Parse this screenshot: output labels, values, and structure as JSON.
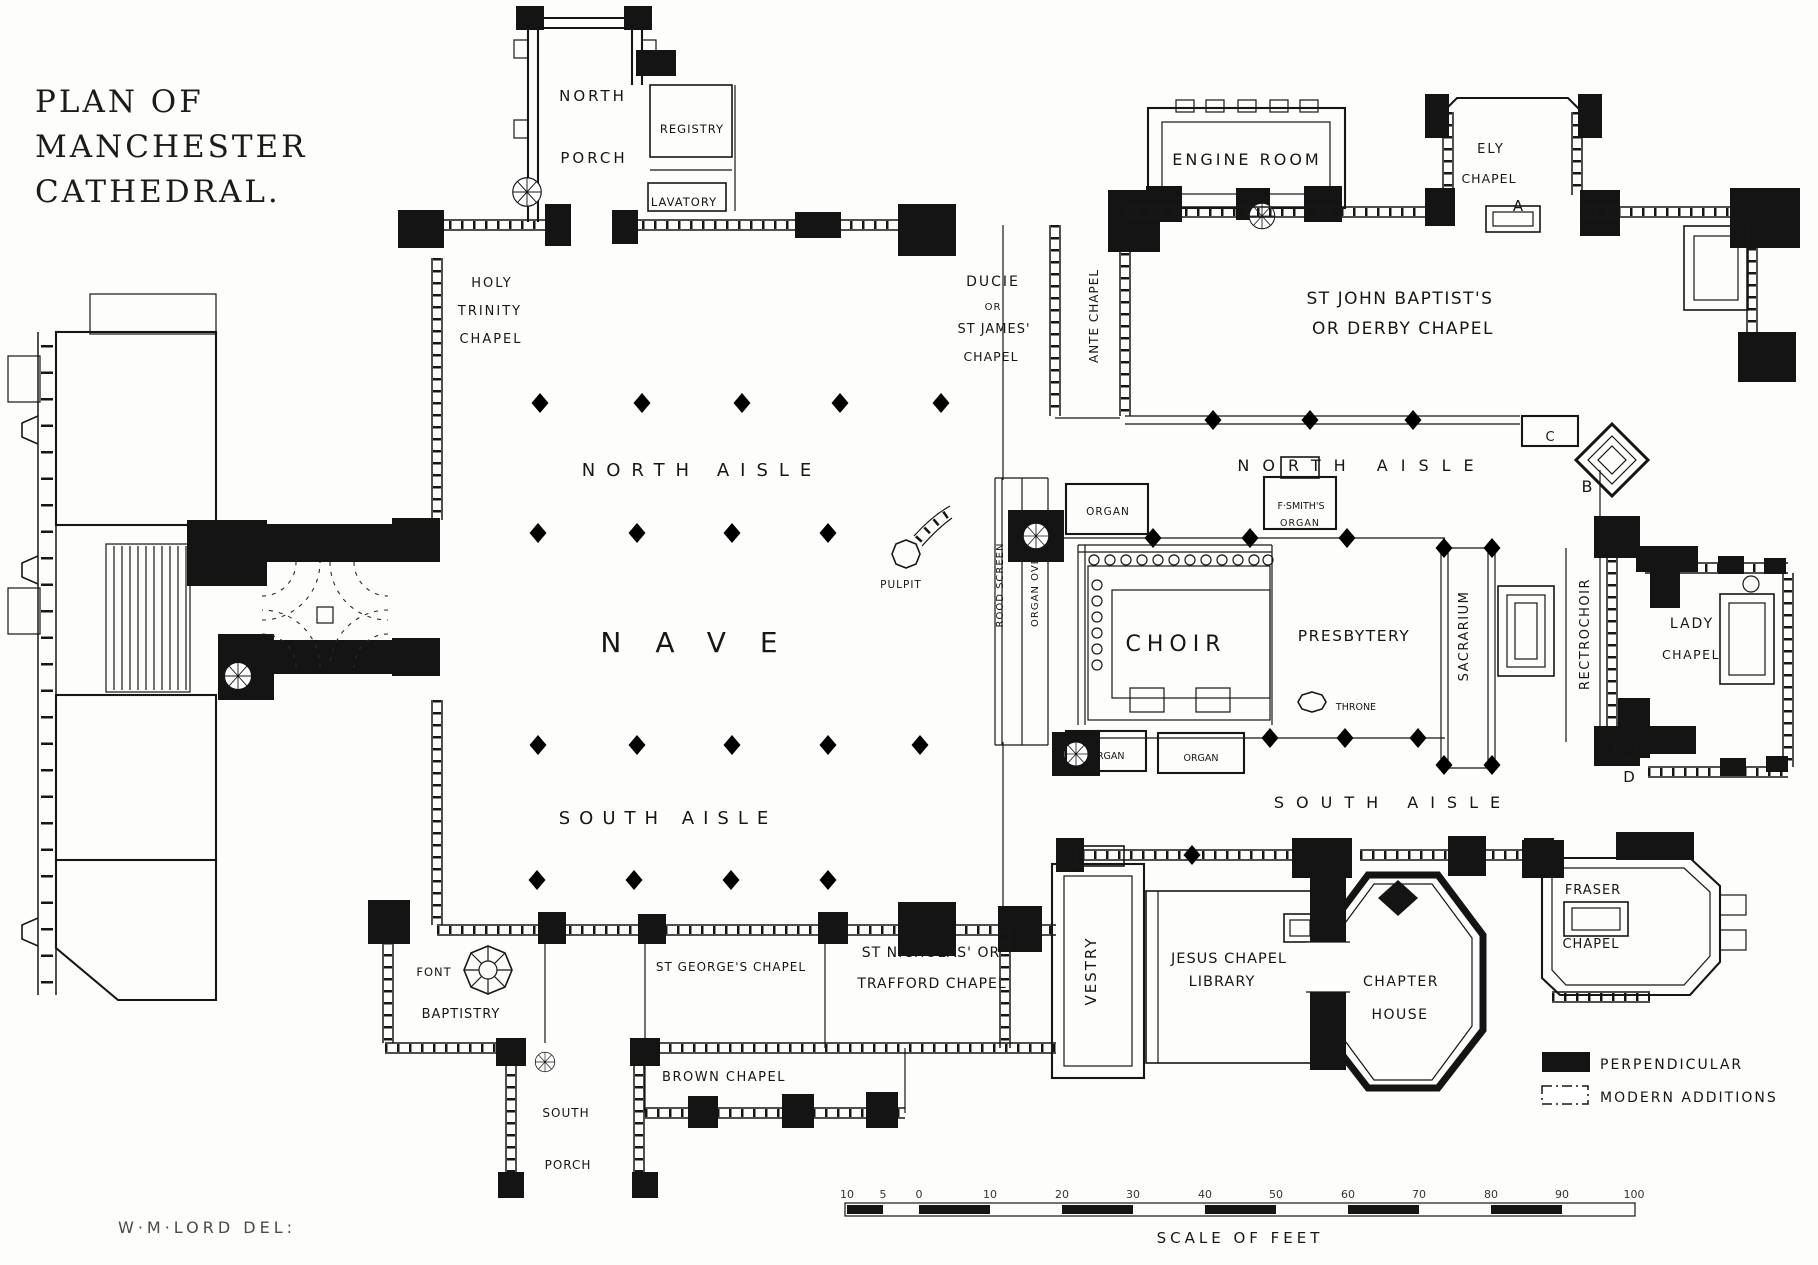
{
  "title": {
    "line1": "PLAN OF",
    "line2": "MANCHESTER",
    "line3": "CATHEDRAL."
  },
  "attribution": "W·M·LORD  DEL:",
  "legend": {
    "items": [
      {
        "label": "PERPENDICULAR",
        "style": "filled",
        "color": "#141414"
      },
      {
        "label": "MODERN ADDITIONS",
        "style": "outline",
        "color": "#ffffff"
      }
    ]
  },
  "scale": {
    "caption": "SCALE OF FEET",
    "ticks": [
      {
        "x": 847,
        "label": "10"
      },
      {
        "x": 883,
        "label": "5"
      },
      {
        "x": 919,
        "label": "0"
      },
      {
        "x": 990,
        "label": "10"
      },
      {
        "x": 1062,
        "label": "20"
      },
      {
        "x": 1133,
        "label": "30"
      },
      {
        "x": 1205,
        "label": "40"
      },
      {
        "x": 1276,
        "label": "50"
      },
      {
        "x": 1348,
        "label": "60"
      },
      {
        "x": 1419,
        "label": "70"
      },
      {
        "x": 1491,
        "label": "80"
      },
      {
        "x": 1562,
        "label": "90"
      },
      {
        "x": 1634,
        "label": "100"
      }
    ]
  },
  "plan_labels": [
    {
      "text": "NORTH",
      "x": 593,
      "y": 101,
      "size": 15,
      "ls": 3
    },
    {
      "text": "PORCH",
      "x": 594,
      "y": 163,
      "size": 15,
      "ls": 3
    },
    {
      "text": "REGISTRY",
      "x": 692,
      "y": 133,
      "size": 11.5,
      "ls": 1
    },
    {
      "text": "LAVATORY",
      "x": 684,
      "y": 206,
      "size": 11.5,
      "ls": 1
    },
    {
      "text": "HOLY",
      "x": 492,
      "y": 287,
      "size": 13,
      "ls": 2
    },
    {
      "text": "TRINITY",
      "x": 490,
      "y": 315,
      "size": 13,
      "ls": 2
    },
    {
      "text": "CHAPEL",
      "x": 491,
      "y": 343,
      "size": 13,
      "ls": 2
    },
    {
      "text": "NORTH AISLE",
      "x": 702,
      "y": 476,
      "size": 18,
      "ls": 11
    },
    {
      "text": "NAVE",
      "x": 706,
      "y": 652,
      "size": 28,
      "ls": 34
    },
    {
      "text": "SOUTH AISLE",
      "x": 668,
      "y": 824,
      "size": 18,
      "ls": 9
    },
    {
      "text": "PULPIT",
      "x": 901,
      "y": 588,
      "size": 10.5,
      "ls": 1
    },
    {
      "text": "DUCIE",
      "x": 993,
      "y": 286,
      "size": 14,
      "ls": 2
    },
    {
      "text": "OR",
      "x": 993,
      "y": 310,
      "size": 10,
      "ls": 1
    },
    {
      "text": "ST JAMES'",
      "x": 994,
      "y": 333,
      "size": 13,
      "ls": 1
    },
    {
      "text": "CHAPEL",
      "x": 991,
      "y": 361,
      "size": 12.5,
      "ls": 1
    },
    {
      "text": "ANTE CHAPEL",
      "x": 1098,
      "y": 316,
      "size": 12,
      "ls": 1,
      "rot": -90
    },
    {
      "text": "ENGINE ROOM",
      "x": 1247,
      "y": 165,
      "size": 16,
      "ls": 3
    },
    {
      "text": "ELY",
      "x": 1491,
      "y": 153,
      "size": 13,
      "ls": 2
    },
    {
      "text": "CHAPEL",
      "x": 1489,
      "y": 183,
      "size": 12.5,
      "ls": 1
    },
    {
      "text": "A",
      "x": 1518,
      "y": 211,
      "size": 15
    },
    {
      "text": "ST JOHN BAPTIST'S",
      "x": 1400,
      "y": 304,
      "size": 17,
      "ls": 1.5
    },
    {
      "text": "OR DERBY CHAPEL",
      "x": 1403,
      "y": 334,
      "size": 17,
      "ls": 1.5
    },
    {
      "text": "C",
      "x": 1550,
      "y": 441,
      "size": 13
    },
    {
      "text": "B",
      "x": 1587,
      "y": 492,
      "size": 16
    },
    {
      "text": "NORTH AISLE",
      "x": 1362,
      "y": 471,
      "size": 16,
      "ls": 13
    },
    {
      "text": "ORGAN",
      "x": 1108,
      "y": 515,
      "size": 10.5,
      "ls": 1
    },
    {
      "text": "F·SMITH'S",
      "x": 1301,
      "y": 509,
      "size": 9.5
    },
    {
      "text": "ORGAN",
      "x": 1300,
      "y": 526,
      "size": 9.5,
      "ls": 1
    },
    {
      "text": "ROOD SCREEN",
      "x": 1003,
      "y": 585,
      "size": 10,
      "ls": 1,
      "rot": -90
    },
    {
      "text": "ORGAN OVER",
      "x": 1038,
      "y": 588,
      "size": 10,
      "ls": 1,
      "rot": -90
    },
    {
      "text": "CHOIR",
      "x": 1176,
      "y": 651,
      "size": 22,
      "ls": 6
    },
    {
      "text": "PRESBYTERY",
      "x": 1354,
      "y": 641,
      "size": 15.5,
      "ls": 1.5
    },
    {
      "text": "THRONE",
      "x": 1356,
      "y": 710,
      "size": 9.5
    },
    {
      "text": "SACRARIUM",
      "x": 1468,
      "y": 636,
      "size": 13,
      "ls": 1.5,
      "rot": -90
    },
    {
      "text": "RECTROCHOIR",
      "x": 1589,
      "y": 634,
      "size": 13,
      "ls": 1.5,
      "rot": -90
    },
    {
      "text": "LADY",
      "x": 1692,
      "y": 628,
      "size": 14,
      "ls": 2
    },
    {
      "text": "CHAPEL",
      "x": 1691,
      "y": 659,
      "size": 12.5,
      "ls": 1.5
    },
    {
      "text": "D",
      "x": 1629,
      "y": 782,
      "size": 15
    },
    {
      "text": "SOUTH AISLE",
      "x": 1393,
      "y": 808,
      "size": 16,
      "ls": 12
    },
    {
      "text": "ORGAN",
      "x": 1107,
      "y": 759,
      "size": 9.5
    },
    {
      "text": "ORGAN",
      "x": 1201,
      "y": 761,
      "size": 9.5
    },
    {
      "text": "VESTRY",
      "x": 1096,
      "y": 971,
      "size": 15,
      "ls": 2,
      "rot": -90
    },
    {
      "text": "JESUS CHAPEL",
      "x": 1229,
      "y": 963,
      "size": 14.5,
      "ls": 1
    },
    {
      "text": "LIBRARY",
      "x": 1222,
      "y": 986,
      "size": 14.5,
      "ls": 1
    },
    {
      "text": "CHAPTER",
      "x": 1401,
      "y": 986,
      "size": 14,
      "ls": 1.5
    },
    {
      "text": "HOUSE",
      "x": 1400,
      "y": 1019,
      "size": 14,
      "ls": 1.5
    },
    {
      "text": "FRASER",
      "x": 1593,
      "y": 894,
      "size": 13,
      "ls": 1
    },
    {
      "text": "CHAPEL",
      "x": 1591,
      "y": 948,
      "size": 13,
      "ls": 1
    },
    {
      "text": "FONT",
      "x": 434,
      "y": 976,
      "size": 11.5,
      "ls": 1
    },
    {
      "text": "BAPTISTRY",
      "x": 461,
      "y": 1018,
      "size": 13,
      "ls": 1
    },
    {
      "text": "ST GEORGE'S CHAPEL",
      "x": 731,
      "y": 971,
      "size": 12,
      "ls": 1
    },
    {
      "text": "ST NICHOLAS' OR",
      "x": 931,
      "y": 957,
      "size": 14,
      "ls": 1
    },
    {
      "text": "TRAFFORD CHAPEL",
      "x": 932,
      "y": 988,
      "size": 14,
      "ls": 1
    },
    {
      "text": "BROWN CHAPEL",
      "x": 724,
      "y": 1081,
      "size": 13,
      "ls": 1.5
    },
    {
      "text": "SOUTH",
      "x": 566,
      "y": 1117,
      "size": 12,
      "ls": 1
    },
    {
      "text": "PORCH",
      "x": 568,
      "y": 1169,
      "size": 12,
      "ls": 1
    }
  ]
}
